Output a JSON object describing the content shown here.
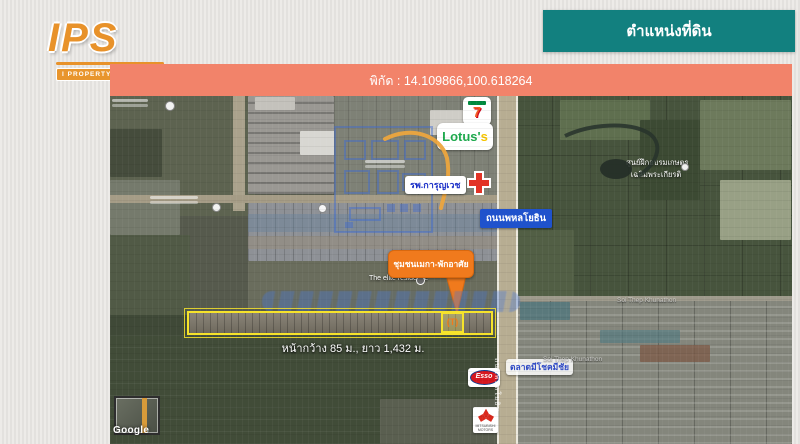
{
  "logo": {
    "name": "IPS",
    "tagline": "I PROPERTY SERVICE",
    "house_icon": "⌂",
    "color": "#e8922a"
  },
  "title_banner": {
    "text": "ตำแหน่งที่ดิน",
    "color": "#12807f"
  },
  "coords_banner": {
    "text": "พิกัด : 14.109866,100.618264",
    "color": "#f2836a"
  },
  "map": {
    "provider": "Google",
    "poi": {
      "seven_eleven": "7",
      "lotus_main": "Lotus'",
      "lotus_s": "s",
      "hospital": "รพ.การุญเวช",
      "market": "ตลาดมีโชคมีชัย",
      "residence": "The elite residence",
      "training_center": [
        "ศูนย์ฝึกอบรมเกษตร",
        "เฉลิมพระเกียรติ"
      ],
      "esso": "Esso",
      "mitsubishi": "MITSUBISHI MOTORS",
      "soi_road_1": "Soi Thep Khunathon",
      "soi_road_2": "Soi Thep Khunathon"
    },
    "roads": {
      "phahonyothin": "ถนนพหลโยธิน",
      "phahonyothin_vertical": "ถนนพหลโยธิน"
    },
    "property": {
      "callout": "ชุมชนเมกา-พักอาศัย",
      "dimensions": "หน้ากว้าง 85 ม., ยาว 1,432 ม.",
      "marker_glyph": "(T)",
      "outline_color": "#f6e32b",
      "callout_color": "#f07a1d"
    }
  }
}
